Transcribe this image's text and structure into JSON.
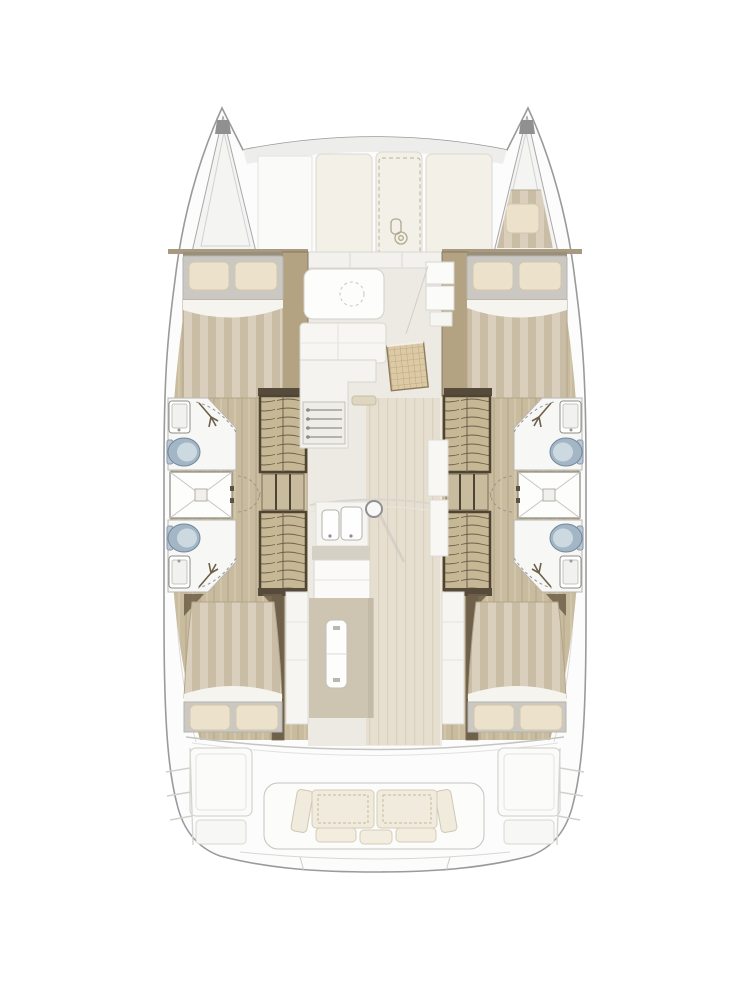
{
  "document": {
    "title": "Catamaran deck and accommodation floor plan",
    "view": "top-down",
    "text_labels": []
  },
  "palette": {
    "hull_outline": "#9a9a9a",
    "hull_fill": "#fcfcfc",
    "bow_fill": "#f4f4f3",
    "wood_light": "#c9bb9d",
    "wood_mid": "#b3a383",
    "wood_dark": "#5f5441",
    "floor_salon": "#eceae3",
    "floor_walkway": "#e6dfd0",
    "bed_stripe_a": "#d9cfbc",
    "bed_stripe_b": "#c9bda6",
    "bed_sheet": "#cbc8c3",
    "bed_turndown": "#f6f4ee",
    "pillow": "#ece2cc",
    "bath_white": "#f7f7f6",
    "fixture_stroke": "#8f8d86",
    "toilet_blue": "#a3b6c5",
    "toilet_lid": "#cdd9e1",
    "stairs_bg": "#c6b795",
    "stairs_line": "#6d604a",
    "rattan_bg": "#dcc9a5",
    "rattan_line": "#b7a076",
    "island_platform": "#cdc4b2",
    "sofa_cream": "#f0ebdc",
    "counter_white": "#f4f3ef",
    "line_light": "#c9c7c2"
  },
  "plan": {
    "foredeck": {
      "port_forepeak": {
        "label": "forepeak locker",
        "contents": "empty storage"
      },
      "starboard_forepeak": {
        "label": "forepeak berth",
        "mattress": "striped",
        "pillows": 1
      },
      "sunpad_panels": 3,
      "anchor_locker": {
        "marker": "dashed hatch outline",
        "icon": "windlass-icon"
      }
    },
    "salon": {
      "forward_dinette": {
        "table": "rounded rectangle",
        "marker": "dashed circle",
        "bench_sections": 2
      },
      "galley_port": {
        "cooktop": true,
        "burner_rails": 4,
        "oven_handle": true
      },
      "galley_center": {
        "double_sink": true,
        "faucets": 2,
        "mast_post": true
      },
      "rattan_cabinet": true,
      "fridge_cabinets": 2,
      "island": {
        "platform": true,
        "drop_leaf_table": true
      }
    },
    "port_hull": {
      "forward_cabin": {
        "bed": "double",
        "pillows": 2,
        "duvet": "striped"
      },
      "forward_bathroom": {
        "fixtures": [
          "sink",
          "toilet",
          "hand-shower"
        ]
      },
      "shower_cabin": {
        "marker": "X diagonals with drain pan"
      },
      "aft_bathroom": {
        "fixtures": [
          "toilet",
          "sink",
          "hand-shower"
        ]
      },
      "companionway": {
        "stair_flights": 2,
        "landing": true
      },
      "aft_cabin": {
        "bed": "double",
        "pillows": 2,
        "duvet": "striped"
      }
    },
    "starboard_hull": {
      "forward_cabin": {
        "bed": "double",
        "pillows": 2,
        "duvet": "striped"
      },
      "forward_bathroom": {
        "fixtures": [
          "sink",
          "toilet",
          "hand-shower"
        ]
      },
      "shower_cabin": {
        "marker": "X diagonals with drain pan"
      },
      "aft_bathroom": {
        "fixtures": [
          "toilet",
          "sink",
          "hand-shower"
        ]
      },
      "companionway": {
        "stair_flights": 2,
        "landing": true
      },
      "aft_cabin": {
        "bed": "double",
        "pillows": 2,
        "duvet": "striped"
      }
    },
    "aft_cockpit": {
      "sofa": {
        "seat_cushions": 2,
        "side_back_cushions": 2,
        "front_pillows": 3
      },
      "side_benches": 2,
      "stern_lockers": 2,
      "transom_steps": 2
    },
    "totals": {
      "cabins": 4,
      "bathrooms": 4,
      "showers": 2,
      "toilets": 4,
      "berths": 5
    }
  }
}
